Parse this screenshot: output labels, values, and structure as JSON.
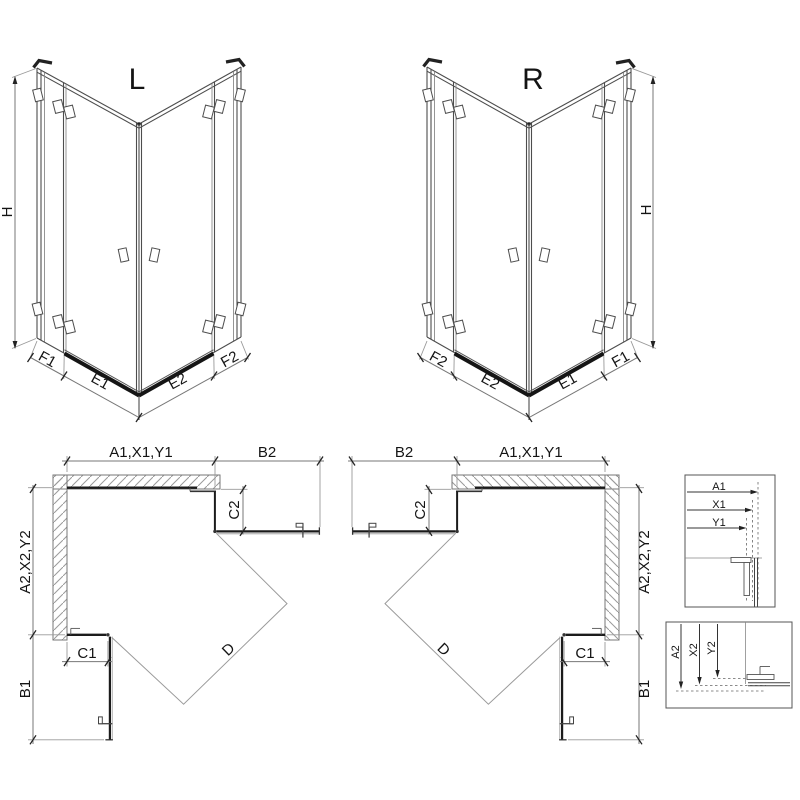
{
  "drawing": {
    "type": "shower-enclosure-technical-drawing",
    "colors": {
      "background": "#ffffff",
      "line": "#4d4d4d",
      "thin_line": "#999999",
      "glass_line": "#1b1b1b",
      "threshold": "#151515",
      "hatch": "#9a9a9a",
      "dim_line": "#777777",
      "text": "#141414"
    }
  },
  "iso_left": {
    "title": "L",
    "dim_height": "H",
    "dim_fixed_left": "F1",
    "dim_door_left": "E1",
    "dim_door_right": "E2",
    "dim_fixed_right": "F2"
  },
  "iso_right": {
    "title": "R",
    "dim_height": "H",
    "dim_fixed_left": "F2",
    "dim_door_left": "E2",
    "dim_door_right": "E1",
    "dim_fixed_right": "F1"
  },
  "plan_left": {
    "dim_width_top": "A1,X1,Y1",
    "dim_door_top": "B2",
    "dim_return_top": "C2",
    "dim_depth_side": "A2,X2,Y2",
    "dim_return_bottom": "C1",
    "dim_door_bottom": "B1",
    "dim_diagonal": "D"
  },
  "plan_right": {
    "dim_width_top": "A1,X1,Y1",
    "dim_door_top": "B2",
    "dim_return_top": "C2",
    "dim_depth_side": "A2,X2,Y2",
    "dim_return_bottom": "C1",
    "dim_door_bottom": "B1",
    "dim_diagonal": "D"
  },
  "detail_width": {
    "a1": "A1",
    "x1": "X1",
    "y1": "Y1"
  },
  "detail_depth": {
    "a2": "A2",
    "x2": "X2",
    "y2": "Y2"
  }
}
